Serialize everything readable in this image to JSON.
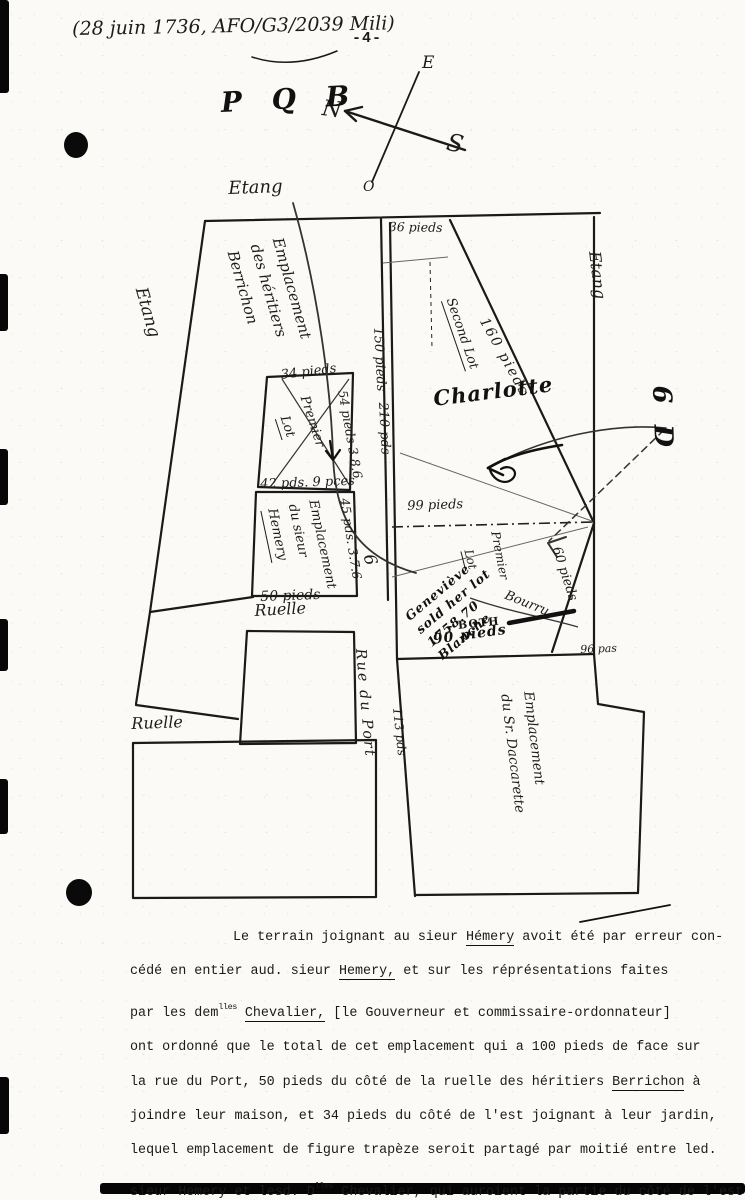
{
  "document": {
    "header_note": "(28 juin 1736, AFO/G3/2039 Mili)",
    "page_number": "-4-"
  },
  "compass": {
    "e": "E",
    "n": "N",
    "s": "S",
    "o": "O"
  },
  "pencil_notes": {
    "pqb": "P Q B",
    "charlotte": "Charlotte",
    "scribble_l1": "Geneviève",
    "scribble_l2": "sold her lot",
    "scribble_l3": "1758.70",
    "scribble_l4": "Blanche",
    "both": "- BOTH",
    "pieds_90": "90 pieds",
    "margin_mark": "6 D",
    "street_glyph": "6"
  },
  "map_labels": {
    "etang_top": "Etang",
    "etang_left": "Etang",
    "etang_right": "Etang",
    "berrichon_l1": "Emplacement",
    "berrichon_l2": "des héritiers",
    "berrichon_l3": "Berrichon",
    "pieds_36": "36 pieds",
    "pieds_150": "150 pieds",
    "pds_210": "210 pds",
    "pieds_34": "34 pieds",
    "premier_1": "Premier",
    "lot_1": "Lot",
    "pieds_54": "54 pieds 3.8.6",
    "pds_42": "42 pds. 9 pces",
    "pds_45": "45 pds. 3.7.6",
    "hemery_l1": "Emplacement",
    "hemery_l2": "du sieur",
    "hemery_l3": "Hemery",
    "pieds_50": "50 pieds",
    "ruelle_1": "Ruelle",
    "ruelle_2": "Ruelle",
    "rue_du_port": "Rue du Port",
    "pds_113": "113 pds",
    "second_lot": "Second Lot",
    "pieds_160": "160 pieds",
    "pieds_99": "99 pieds",
    "lot_2": "Lot",
    "premier_2": "Premier",
    "bourru": "Bourru",
    "pieds_60": "60 pieds",
    "pas_96": "96 pas",
    "daccarette_l1": "Emplacement",
    "daccarette_l2": "du Sr. Daccarette"
  },
  "paragraph": {
    "lines": [
      {
        "indent": true,
        "segments": [
          {
            "t": "Le terrain joignant au sieur "
          },
          {
            "t": "Hémery",
            "u": 1
          },
          {
            "t": " avoit été par erreur con-"
          }
        ]
      },
      {
        "segments": [
          {
            "t": "cédé en entier aud. sieur "
          },
          {
            "t": "Hemery,",
            "u": 1
          },
          {
            "t": " et sur les réprésentations faites"
          }
        ]
      },
      {
        "segments": [
          {
            "t": "par les dem"
          },
          {
            "t": "lles",
            "sup": 1
          },
          {
            "t": " "
          },
          {
            "t": "Chevalier,",
            "u": 1
          },
          {
            "t": " [le Gouverneur et commissaire-ordonnateur]"
          }
        ]
      },
      {
        "segments": [
          {
            "t": "ont ordonné que le total de cet emplacement qui a 100 pieds de face sur"
          }
        ]
      },
      {
        "segments": [
          {
            "t": "la rue du Port, 50 pieds du côté de la ruelle des héritiers "
          },
          {
            "t": "Berrichon",
            "u": 1
          },
          {
            "t": " à"
          }
        ]
      },
      {
        "segments": [
          {
            "t": "joindre leur maison, et 34 pieds du côté de l'est joignant à leur jardin,"
          }
        ]
      },
      {
        "segments": [
          {
            "t": "lequel emplacement de figure trapèze seroit partagé par moitié entre led."
          }
        ]
      },
      {
        "segments": [
          {
            "t": "sieur "
          },
          {
            "t": "Hemery",
            "u": 1
          },
          {
            "t": " et lesd. D"
          },
          {
            "t": "lles",
            "sup": 1
          },
          {
            "t": " "
          },
          {
            "t": "Chevalier,",
            "u": 1
          },
          {
            "t": " qui auroient la partie du côté de l'est"
          }
        ]
      }
    ]
  }
}
